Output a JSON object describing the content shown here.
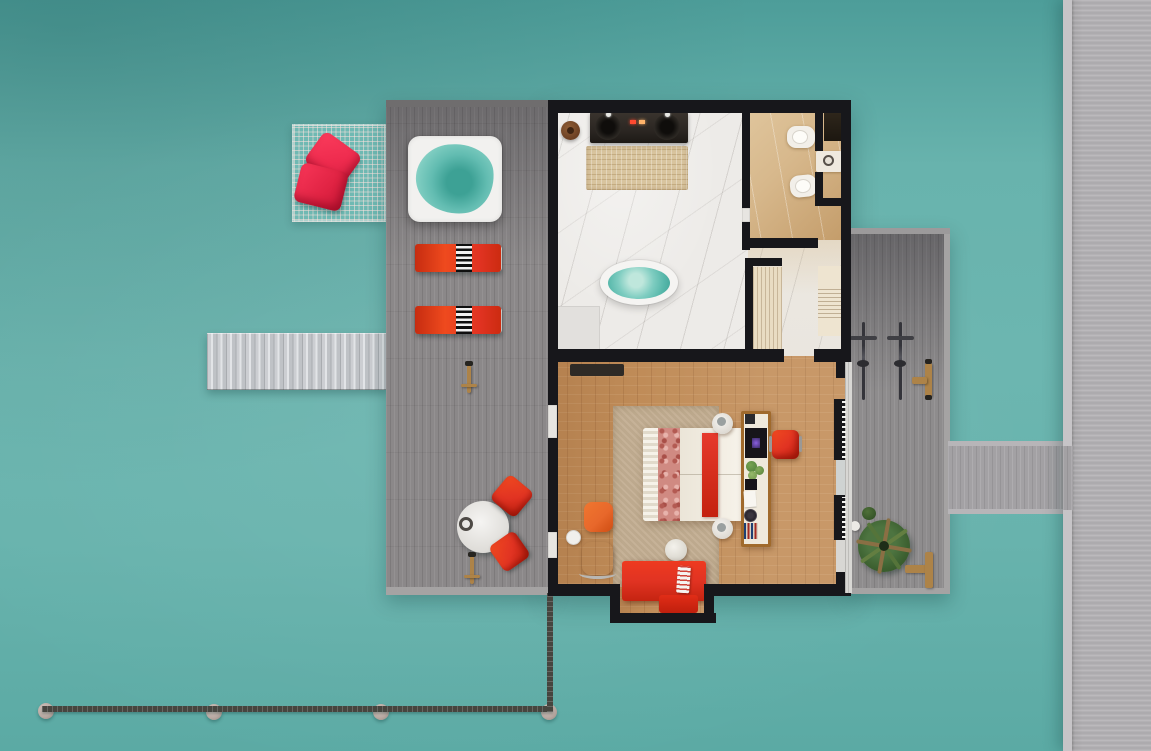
{
  "scene": {
    "type": "top-down-3d-floor-plan-render",
    "subject": "overwater-villa-with-deck-and-jetty",
    "width_px": 1151,
    "height_px": 751
  },
  "colors": {
    "water_top": "#4d9d99",
    "water_mid": "#68b3ad",
    "water_low": "#5baaa4",
    "deck": "#8b8889",
    "deck_edge": "#a5a3a3",
    "jetty": "#b3b1b4",
    "jetty_edge": "#c6c4c7",
    "bridge": "#a3a1a4",
    "boardwalk": "#46453f",
    "post": "#b9aaa3",
    "wall": "#17171b",
    "marble": "#edebe8",
    "shower": "#e2e0dd",
    "beige": "#d7b88c",
    "hall": "#eae6df",
    "wood": "#c08c58",
    "rug": "#c3ae92",
    "red": "#e13322",
    "red_deep": "#c4210f",
    "crimson": "#ee2b4e",
    "orange": "#e8682b",
    "cream": "#e9dcc2",
    "pool": "#7fcdc1",
    "pool_deep": "#3da195",
    "counter": "#2b2622",
    "wood_trim": "#a06a2c",
    "wood_item": "#ad8348",
    "palm": "#49703a",
    "palm_dark": "#2f4d23",
    "glass": "#d8d7d4"
  },
  "regions": {
    "water": {
      "label": "lagoon-water"
    },
    "sun_deck": {
      "label": "sun-deck",
      "items": [
        "overwater-net",
        "net-pillows",
        "jacuzzi",
        "sun-loungers",
        "deck-lamps",
        "outdoor-table",
        "outdoor-chairs"
      ],
      "lounger_count": 2,
      "pillow_count": 2
    },
    "stairs": {
      "label": "water-access-stairs"
    },
    "villa": {
      "rooms": [
        {
          "label": "bathroom",
          "items": [
            "double-vanity",
            "vanity-rug",
            "wooden-stool",
            "freestanding-bathtub",
            "shower-corner",
            "wall-hooks"
          ]
        },
        {
          "label": "wc",
          "items": [
            "toilet",
            "bidet",
            "washbasin",
            "storage-cabinet"
          ]
        },
        {
          "label": "hallway",
          "items": [
            "closet-shelving",
            "wardrobe-shelves"
          ]
        },
        {
          "label": "bedroom",
          "items": [
            "double-bed",
            "bed-runner",
            "nightstands",
            "media-console",
            "tv",
            "minibar",
            "desk-chair",
            "armchair",
            "ottoman",
            "side-table",
            "pouf",
            "daybed",
            "door-mat",
            "area-rug"
          ]
        }
      ]
    },
    "right_deck": {
      "label": "rear-deck",
      "items": [
        "bicycles",
        "outdoor-shower",
        "palm-planter",
        "wood-bench",
        "deck-ball",
        "shrub"
      ],
      "bicycle_count": 2
    },
    "bridge": {
      "label": "deck-to-jetty-bridge"
    },
    "jetty": {
      "label": "main-jetty"
    },
    "boardwalk": {
      "label": "boardwalk",
      "post_count": 4
    }
  }
}
